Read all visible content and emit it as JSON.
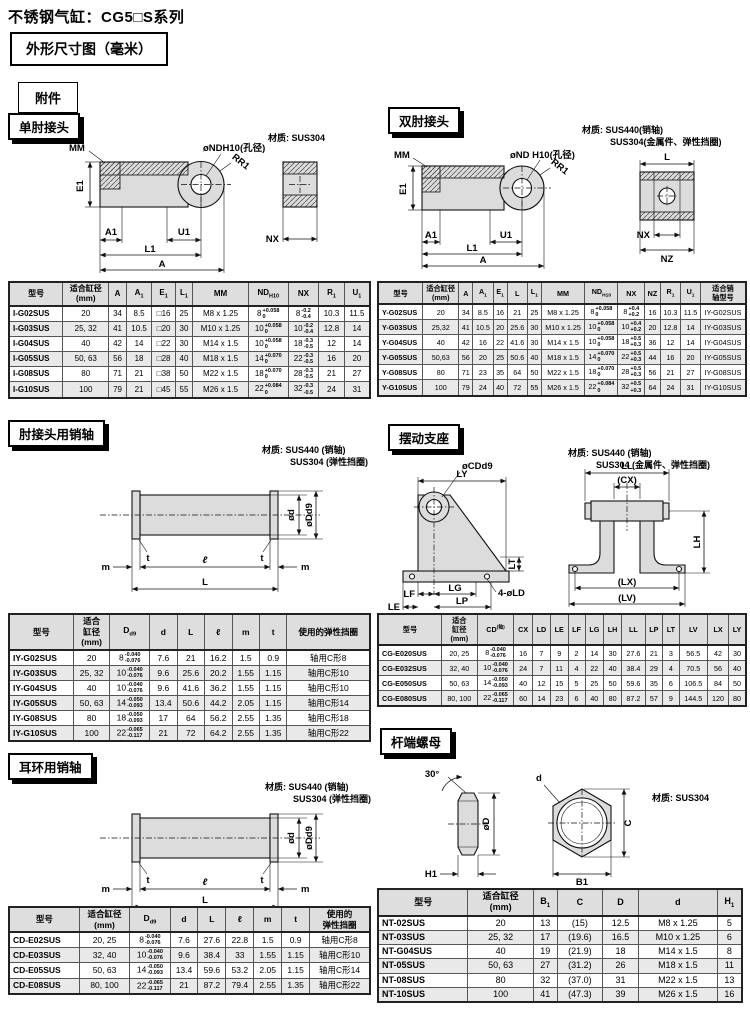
{
  "page": {
    "title": "不锈钢气缸：CG5□S系列",
    "dim_box": "外形尺寸图（毫米）",
    "acc_box": "附件"
  },
  "single_knuckle": {
    "heading": "单肘接头",
    "material": "材质: SUS304",
    "labels": {
      "mm": "MM",
      "nd": "øNDH10(孔径)",
      "rr1": "RR1",
      "e1": "E1",
      "a1": "A1",
      "u1": "U1",
      "l1": "L1",
      "a": "A",
      "nx": "NX"
    },
    "table": {
      "headers": [
        "型号",
        {
          "lines": [
            "适合缸径",
            "(mm)"
          ]
        },
        "A",
        {
          "t": "A",
          "sub": "1"
        },
        {
          "t": "E",
          "sub": "1"
        },
        {
          "t": "L",
          "sub": "1"
        },
        "MM",
        {
          "t": "ND",
          "sub": "H10"
        },
        "NX",
        {
          "t": "R",
          "sub": "1"
        },
        {
          "t": "U",
          "sub": "1"
        }
      ],
      "rows": [
        [
          "I-G02SUS",
          "20",
          "34",
          "8.5",
          "□16",
          "25",
          "M8 x 1.25",
          {
            "v": "8",
            "sup": "+0.058",
            "sub": "0"
          },
          {
            "v": "8",
            "sup": "-0.2",
            "sub": "-0.4"
          },
          "10.3",
          "11.5"
        ],
        [
          "I-G03SUS",
          "25, 32",
          "41",
          "10.5",
          "□20",
          "30",
          "M10 x 1.25",
          {
            "v": "10",
            "sup": "+0.058",
            "sub": "0"
          },
          {
            "v": "10",
            "sup": "-0.2",
            "sub": "-0.4"
          },
          "12.8",
          "14"
        ],
        [
          "I-G04SUS",
          "40",
          "42",
          "14",
          "□22",
          "30",
          "M14 x 1.5",
          {
            "v": "10",
            "sup": "+0.058",
            "sub": "0"
          },
          {
            "v": "18",
            "sup": "-0.3",
            "sub": "-0.5"
          },
          "12",
          "14"
        ],
        [
          "I-G05SUS",
          "50, 63",
          "56",
          "18",
          "□28",
          "40",
          "M18 x 1.5",
          {
            "v": "14",
            "sup": "+0.070",
            "sub": "0"
          },
          {
            "v": "22",
            "sup": "-0.3",
            "sub": "-0.5"
          },
          "16",
          "20"
        ],
        [
          "I-G08SUS",
          "80",
          "71",
          "21",
          "□38",
          "50",
          "M22 x 1.5",
          {
            "v": "18",
            "sup": "+0.070",
            "sub": "0"
          },
          {
            "v": "28",
            "sup": "-0.3",
            "sub": "-0.5"
          },
          "21",
          "27"
        ],
        [
          "I-G10SUS",
          "100",
          "79",
          "21",
          "□45",
          "55",
          "M26 x 1.5",
          {
            "v": "22",
            "sup": "+0.084",
            "sub": "0"
          },
          {
            "v": "32",
            "sup": "-0.3",
            "sub": "-0.5"
          },
          "24",
          "31"
        ]
      ]
    }
  },
  "double_knuckle": {
    "heading": "双肘接头",
    "material": "材质: SUS440(销轴)",
    "material2": "SUS304(金属件、弹性挡圈)",
    "labels": {
      "mm": "MM",
      "nd": "øND H10(孔径)",
      "rr1": "RR1",
      "e1": "E1",
      "a1": "A1",
      "u1": "U1",
      "l1": "L1",
      "a": "A",
      "l": "L",
      "nx": "NX",
      "nz": "NZ"
    },
    "table": {
      "headers": [
        "型号",
        {
          "lines": [
            "适合缸径",
            "(mm)"
          ]
        },
        "A",
        {
          "t": "A",
          "sub": "1"
        },
        {
          "t": "E",
          "sub": "1"
        },
        "L",
        {
          "t": "L",
          "sub": "1"
        },
        "MM",
        {
          "t": "ND",
          "sub": "H10"
        },
        "NX",
        "NZ",
        {
          "t": "R",
          "sub": "1"
        },
        {
          "t": "U",
          "sub": "1"
        },
        {
          "lines": [
            "适合销",
            "轴型号"
          ]
        }
      ],
      "rows": [
        [
          "Y-G02SUS",
          "20",
          "34",
          "8.5",
          "16",
          "21",
          "25",
          "M8 x 1.25",
          {
            "v": "8",
            "sup": "+0.058",
            "sub": "0"
          },
          {
            "v": "8",
            "sup": "+0.4",
            "sub": "+0.2"
          },
          "16",
          "10.3",
          "11.5",
          "IY-G02SUS"
        ],
        [
          "Y-G03SUS",
          "25,32",
          "41",
          "10.5",
          "20",
          "25.6",
          "30",
          "M10 x 1.25",
          {
            "v": "10",
            "sup": "+0.058",
            "sub": "0"
          },
          {
            "v": "10",
            "sup": "+0.4",
            "sub": "+0.2"
          },
          "20",
          "12.8",
          "14",
          "IY-G03SUS"
        ],
        [
          "Y-G04SUS",
          "40",
          "42",
          "16",
          "22",
          "41.6",
          "30",
          "M14 x 1.5",
          {
            "v": "10",
            "sup": "+0.058",
            "sub": "0"
          },
          {
            "v": "18",
            "sup": "+0.5",
            "sub": "+0.3"
          },
          "36",
          "12",
          "14",
          "IY-G04SUS"
        ],
        [
          "Y-G05SUS",
          "50,63",
          "56",
          "20",
          "25",
          "50.6",
          "40",
          "M18 x 1.5",
          {
            "v": "14",
            "sup": "+0.070",
            "sub": "0"
          },
          {
            "v": "22",
            "sup": "+0.5",
            "sub": "+0.3"
          },
          "44",
          "16",
          "20",
          "IY-G05SUS"
        ],
        [
          "Y-G08SUS",
          "80",
          "71",
          "23",
          "35",
          "64",
          "50",
          "M22 x 1.5",
          {
            "v": "18",
            "sup": "+0.070",
            "sub": "0"
          },
          {
            "v": "28",
            "sup": "+0.5",
            "sub": "+0.3"
          },
          "56",
          "21",
          "27",
          "IY-G08SUS"
        ],
        [
          "Y-G10SUS",
          "100",
          "79",
          "24",
          "40",
          "72",
          "55",
          "M26 x 1.5",
          {
            "v": "22",
            "sup": "+0.084",
            "sub": "0"
          },
          {
            "v": "32",
            "sup": "+0.5",
            "sub": "+0.3"
          },
          "64",
          "24",
          "31",
          "IY-G10SUS"
        ]
      ]
    }
  },
  "knuckle_pin": {
    "heading": "肘接头用销轴",
    "material": "材质: SUS440 (销轴)",
    "material2": "SUS304 (弹性挡圈)",
    "labels": {
      "d": "ød",
      "dd9": "øDd9",
      "t": "t",
      "l_small": "ℓ",
      "m": "m",
      "l_big": "L"
    },
    "table": {
      "headers": [
        "型号",
        {
          "lines": [
            "适合",
            "缸径",
            "(mm)"
          ]
        },
        {
          "t": "D",
          "sub": "d9"
        },
        "d",
        "L",
        "ℓ",
        "m",
        "t",
        "使用的弹性挡圈"
      ],
      "rows": [
        [
          "IY-G02SUS",
          "20",
          {
            "v": "8",
            "sup": "-0.040",
            "sub": "-0.076"
          },
          "7.6",
          "21",
          "16.2",
          "1.5",
          "0.9",
          "轴用C形8"
        ],
        [
          "IY-G03SUS",
          "25, 32",
          {
            "v": "10",
            "sup": "-0.040",
            "sub": "-0.076"
          },
          "9.6",
          "25.6",
          "20.2",
          "1.55",
          "1.15",
          "轴用C形10"
        ],
        [
          "IY-G04SUS",
          "40",
          {
            "v": "10",
            "sup": "-0.040",
            "sub": "-0.076"
          },
          "9.6",
          "41.6",
          "36.2",
          "1.55",
          "1.15",
          "轴用C形10"
        ],
        [
          "IY-G05SUS",
          "50, 63",
          {
            "v": "14",
            "sup": "-0.050",
            "sub": "-0.093"
          },
          "13.4",
          "50.6",
          "44.2",
          "2.05",
          "1.15",
          "轴用C形14"
        ],
        [
          "IY-G08SUS",
          "80",
          {
            "v": "18",
            "sup": "-0.050",
            "sub": "-0.093"
          },
          "17",
          "64",
          "56.2",
          "2.55",
          "1.35",
          "轴用C形18"
        ],
        [
          "IY-G10SUS",
          "100",
          {
            "v": "22",
            "sup": "-0.065",
            "sub": "-0.117"
          },
          "21",
          "72",
          "64.2",
          "2.55",
          "1.35",
          "轴用C形22"
        ]
      ]
    }
  },
  "trunnion": {
    "heading": "摆动支座",
    "material": "材质: SUS440 (销轴)",
    "material2": "SUS304 (金属件、弹性挡圈)",
    "labels": {
      "cd": "øCDd9",
      "ly": "LY",
      "ll": "LL",
      "cx": "(CX)",
      "lt": "LT",
      "lh": "LH",
      "lf": "LF",
      "lg": "LG",
      "ld": "4-øLD",
      "le": "LE",
      "lp": "LP",
      "lx": "(LX)",
      "lv": "(LV)"
    },
    "table": {
      "headers": [
        "型号",
        {
          "lines": [
            "适合",
            "缸径",
            "(mm)"
          ]
        },
        {
          "t": "CD",
          "sup": "(轴)"
        },
        "CX",
        "LD",
        "LE",
        "LF",
        "LG",
        "LH",
        "LL",
        "LP",
        "LT",
        "LV",
        "LX",
        "LY"
      ],
      "rows": [
        [
          "CG-E020SUS",
          "20, 25",
          {
            "v": "8",
            "sup": "-0.040",
            "sub": "-0.076"
          },
          "16",
          "7",
          "9",
          "2",
          "14",
          "30",
          "27.6",
          "21",
          "3",
          "56.5",
          "42",
          "30"
        ],
        [
          "CG-E032SUS",
          "32, 40",
          {
            "v": "10",
            "sup": "-0.040",
            "sub": "-0.076"
          },
          "24",
          "7",
          "11",
          "4",
          "22",
          "40",
          "38.4",
          "29",
          "4",
          "70.5",
          "56",
          "40"
        ],
        [
          "CG-E050SUS",
          "50, 63",
          {
            "v": "14",
            "sup": "-0.050",
            "sub": "-0.093"
          },
          "40",
          "12",
          "15",
          "5",
          "25",
          "50",
          "59.6",
          "35",
          "6",
          "106.5",
          "84",
          "50"
        ],
        [
          "CG-E080SUS",
          "80, 100",
          {
            "v": "22",
            "sup": "-0.065",
            "sub": "-0.117"
          },
          "60",
          "14",
          "23",
          "6",
          "40",
          "80",
          "87.2",
          "57",
          "9",
          "144.5",
          "120",
          "80"
        ]
      ]
    }
  },
  "clevis_pin": {
    "heading": "耳环用销轴",
    "material": "材质: SUS440 (销轴)",
    "material2": "SUS304 (弹性挡圈)",
    "labels": {
      "d": "ød",
      "dd9": "øDd9",
      "t": "t",
      "l_small": "ℓ",
      "m": "m",
      "l_big": "L"
    },
    "table": {
      "headers": [
        "型号",
        {
          "lines": [
            "适合缸径",
            "(mm)"
          ]
        },
        {
          "t": "D",
          "sub": "d9"
        },
        "d",
        "L",
        "ℓ",
        "m",
        "t",
        {
          "lines": [
            "使用的",
            "弹性挡圈"
          ]
        }
      ],
      "rows": [
        [
          "CD-E02SUS",
          "20, 25",
          {
            "v": "8",
            "sup": "-0.040",
            "sub": "-0.076"
          },
          "7.6",
          "27.6",
          "22.8",
          "1.5",
          "0.9",
          "轴用C形8"
        ],
        [
          "CD-E03SUS",
          "32, 40",
          {
            "v": "10",
            "sup": "-0.040",
            "sub": "-0.076"
          },
          "9.6",
          "38.4",
          "33",
          "1.55",
          "1.15",
          "轴用C形10"
        ],
        [
          "CD-E05SUS",
          "50, 63",
          {
            "v": "14",
            "sup": "-0.050",
            "sub": "-0.093"
          },
          "13.4",
          "59.6",
          "53.2",
          "2.05",
          "1.15",
          "轴用C形14"
        ],
        [
          "CD-E08SUS",
          "80, 100",
          {
            "v": "22",
            "sup": "-0.065",
            "sub": "-0.117"
          },
          "21",
          "87.2",
          "79.4",
          "2.55",
          "1.35",
          "轴用C形22"
        ]
      ]
    }
  },
  "rod_end_nut": {
    "heading": "杆端螺母",
    "material": "材质: SUS304",
    "labels": {
      "angle": "30°",
      "d_big": "øD",
      "h1": "H1",
      "d": "d",
      "c": "C",
      "b1": "B1"
    },
    "table": {
      "headers": [
        "型号",
        {
          "lines": [
            "适合缸径",
            "(mm)"
          ]
        },
        {
          "t": "B",
          "sub": "1"
        },
        "C",
        "D",
        "d",
        {
          "t": "H",
          "sub": "1"
        }
      ],
      "rows": [
        [
          "NT-02SUS",
          "20",
          "13",
          "(15)",
          "12.5",
          "M8 x 1.25",
          "5"
        ],
        [
          "NT-03SUS",
          "25, 32",
          "17",
          "(19.6)",
          "16.5",
          "M10 x 1.25",
          "6"
        ],
        [
          "NT-G04SUS",
          "40",
          "19",
          "(21.9)",
          "18",
          "M14 x 1.5",
          "8"
        ],
        [
          "NT-05SUS",
          "50, 63",
          "27",
          "(31.2)",
          "26",
          "M18 x 1.5",
          "11"
        ],
        [
          "NT-08SUS",
          "80",
          "32",
          "(37.0)",
          "31",
          "M22 x 1.5",
          "13"
        ],
        [
          "NT-10SUS",
          "100",
          "41",
          "(47.3)",
          "39",
          "M26 x 1.5",
          "16"
        ]
      ]
    }
  }
}
